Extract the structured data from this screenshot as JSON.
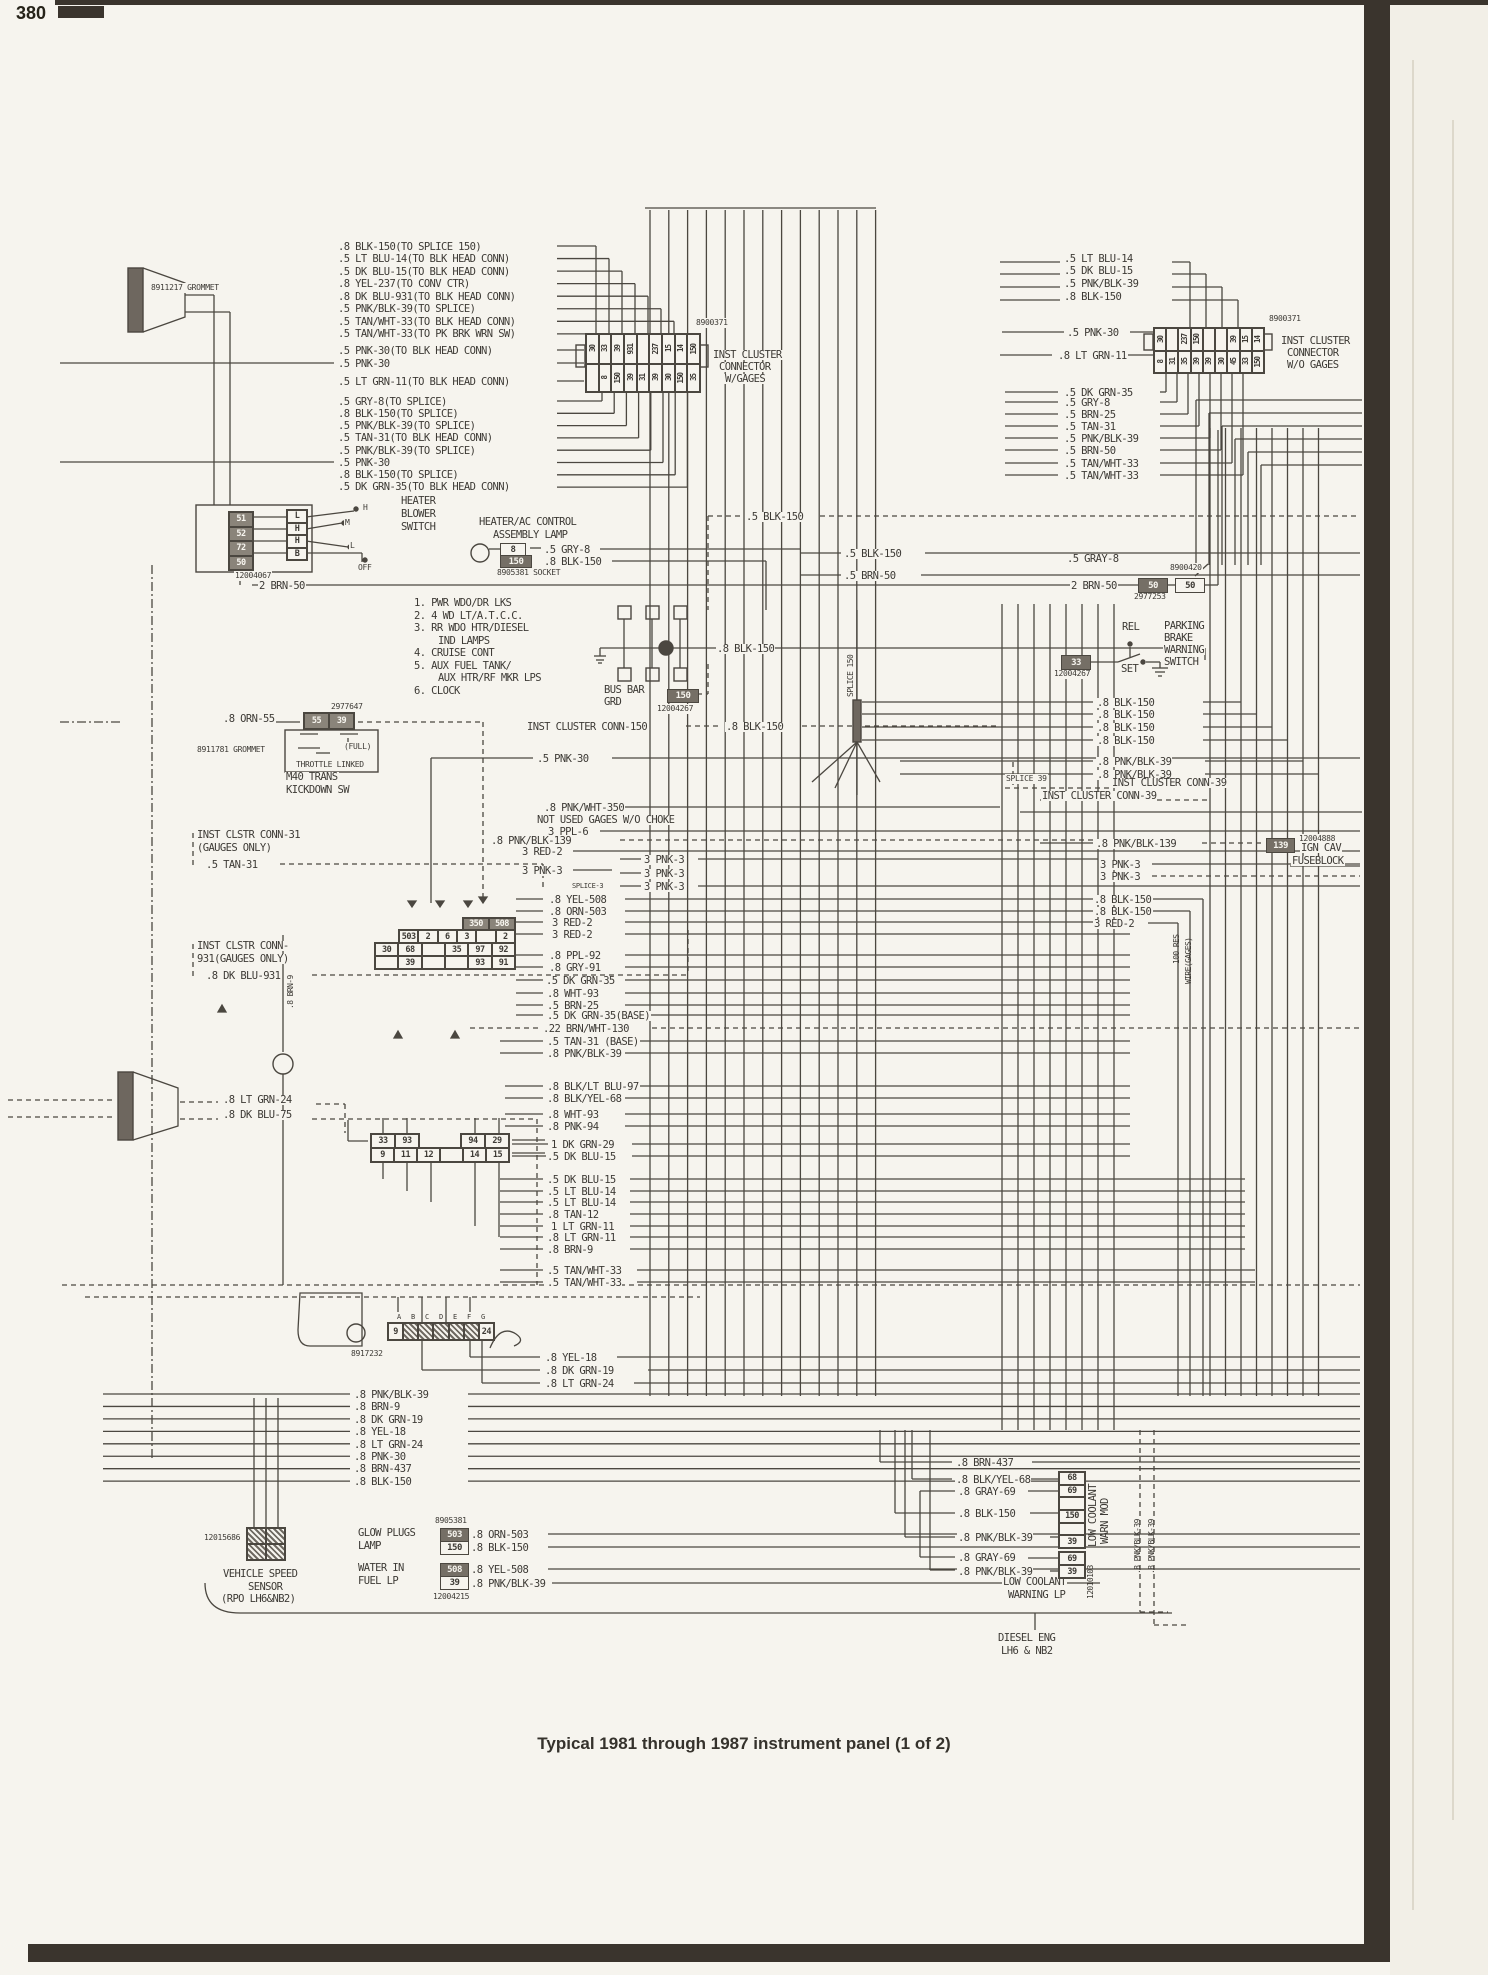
{
  "page": {
    "number": "380",
    "caption": "Typical 1981 through 1987 instrument panel (1 of 2)"
  },
  "colors": {
    "paper": "#f6f4ee",
    "ink": "#3d3a35",
    "line": "#4b4740",
    "shade": "#756f66",
    "edge": "#3a342d"
  },
  "labels": [
    [
      ".8 BLK-150(TO SPLICE 150)",
      337,
      242
    ],
    [
      ".5 LT BLU-14(TO BLK HEAD CONN)",
      337,
      254
    ],
    [
      ".5 DK BLU-15(TO BLK HEAD CONN)",
      337,
      267
    ],
    [
      ".8 YEL-237(TO CONV CTR)",
      337,
      279
    ],
    [
      ".8 DK BLU-931(TO BLK HEAD CONN)",
      337,
      292
    ],
    [
      ".5 PNK/BLK-39(TO SPLICE)",
      337,
      304
    ],
    [
      ".5 TAN/WHT-33(TO BLK HEAD CONN)",
      337,
      317
    ],
    [
      ".5 TAN/WHT-33(TO PK BRK WRN SW)",
      337,
      329
    ],
    [
      ".5 PNK-30(TO BLK HEAD CONN)",
      337,
      346
    ],
    [
      ".5 PNK-30",
      337,
      359
    ],
    [
      ".5 LT GRN-11(TO BLK HEAD CONN)",
      337,
      377
    ],
    [
      ".5 GRY-8(TO SPLICE)",
      337,
      397
    ],
    [
      ".8 BLK-150(TO SPLICE)",
      337,
      409
    ],
    [
      ".5 PNK/BLK-39(TO SPLICE)",
      337,
      421
    ],
    [
      ".5 TAN-31(TO BLK HEAD CONN)",
      337,
      433
    ],
    [
      ".5 PNK/BLK-39(TO SPLICE)",
      337,
      446
    ],
    [
      ".5 PNK-30",
      337,
      458
    ],
    [
      ".8 BLK-150(TO SPLICE)",
      337,
      470
    ],
    [
      ".5 DK GRN-35(TO BLK HEAD CONN)",
      337,
      482
    ],
    [
      "8900371",
      695,
      318,
      "s"
    ],
    [
      "INST CLUSTER",
      712,
      350
    ],
    [
      "CONNECTOR",
      718,
      362
    ],
    [
      "W/GAGES",
      724,
      374
    ],
    [
      "8911217 GROMMET",
      150,
      283,
      "s"
    ],
    [
      ".5 LT BLU-14",
      1063,
      254
    ],
    [
      ".5 DK BLU-15",
      1063,
      266
    ],
    [
      ".5 PNK/BLK-39",
      1063,
      279
    ],
    [
      ".8 BLK-150",
      1063,
      292
    ],
    [
      ".5 PNK-30",
      1066,
      328
    ],
    [
      ".8 LT GRN-11",
      1057,
      351
    ],
    [
      ".5 DK GRN-35",
      1063,
      388
    ],
    [
      ".5 GRY-8",
      1063,
      398
    ],
    [
      ".5 BRN-25",
      1063,
      410
    ],
    [
      ".5 TAN-31",
      1063,
      422
    ],
    [
      ".5 PNK/BLK-39",
      1063,
      434
    ],
    [
      ".5 BRN-50",
      1063,
      446
    ],
    [
      ".5 TAN/WHT-33",
      1063,
      459
    ],
    [
      ".5 TAN/WHT-33",
      1063,
      471
    ],
    [
      "8900371",
      1268,
      314,
      "s"
    ],
    [
      "INST CLUSTER",
      1280,
      336
    ],
    [
      "CONNECTOR",
      1286,
      348
    ],
    [
      "W/O GAGES",
      1286,
      360
    ],
    [
      "HEATER",
      400,
      496
    ],
    [
      "BLOWER",
      400,
      509
    ],
    [
      "SWITCH",
      400,
      522
    ],
    [
      "12004067",
      234,
      571,
      "s"
    ],
    [
      "2 BRN-50",
      258,
      581
    ],
    [
      "H",
      362,
      503,
      "s"
    ],
    [
      "M",
      344,
      518,
      "s"
    ],
    [
      "L",
      349,
      541,
      "s"
    ],
    [
      "OFF",
      357,
      563,
      "s"
    ],
    [
      "HEATER/AC CONTROL",
      478,
      517
    ],
    [
      "ASSEMBLY LAMP",
      492,
      530
    ],
    [
      ".5 GRY-8",
      543,
      545
    ],
    [
      ".8 BLK-150",
      543,
      557
    ],
    [
      "8905381 SOCKET",
      496,
      568,
      "s"
    ],
    [
      "1. PWR WDO/DR LKS",
      413,
      598
    ],
    [
      "2. 4 WD LT/A.T.C.C.",
      413,
      611
    ],
    [
      "3. RR WDO HTR/DIESEL",
      413,
      623
    ],
    [
      "IND LAMPS",
      437,
      636
    ],
    [
      "4. CRUISE CONT",
      413,
      648
    ],
    [
      "5. AUX FUEL TANK/",
      413,
      661
    ],
    [
      "AUX HTR/RF MKR LPS",
      437,
      673
    ],
    [
      "6. CLOCK",
      413,
      686
    ],
    [
      ".8 BLK-150",
      716,
      644
    ],
    [
      "BUS BAR",
      603,
      685
    ],
    [
      "GRD",
      603,
      697
    ],
    [
      "12004267",
      656,
      704,
      "s"
    ],
    [
      "INST CLUSTER CONN-150",
      526,
      722
    ],
    [
      ".8 BLK-150",
      725,
      722
    ],
    [
      ".5 PNK-30",
      536,
      754
    ],
    [
      ".5 BLK-150",
      745,
      512
    ],
    [
      ".5 BLK-150",
      843,
      549
    ],
    [
      ".5 BRN-50",
      843,
      571
    ],
    [
      ".5 GRAY-8",
      1066,
      554
    ],
    [
      "8900420",
      1169,
      563,
      "s"
    ],
    [
      "2 BRN-50",
      1070,
      581
    ],
    [
      "2977253",
      1133,
      592,
      "s"
    ],
    [
      "REL",
      1121,
      622
    ],
    [
      "SET",
      1120,
      664
    ],
    [
      "PARKING",
      1163,
      621
    ],
    [
      "BRAKE",
      1163,
      633
    ],
    [
      "WARNING",
      1163,
      645
    ],
    [
      "SWITCH",
      1163,
      657
    ],
    [
      "12004267",
      1053,
      669,
      "s"
    ],
    [
      ".8 BLK-150",
      1096,
      698
    ],
    [
      ".8 BLK-150",
      1096,
      710
    ],
    [
      ".8 BLK-150",
      1096,
      723
    ],
    [
      ".8 BLK-150",
      1096,
      736
    ],
    [
      ".8 PNK/BLK-39",
      1096,
      757
    ],
    [
      ".8 PNK/BLK-39",
      1096,
      770
    ],
    [
      "SPLICE 39",
      1005,
      774,
      "s"
    ],
    [
      "INST CLUSTER CONN-39",
      1111,
      778
    ],
    [
      "INST CLUSTER CONN-39",
      1041,
      791
    ],
    [
      "SPLICE 150",
      846,
      698,
      "vs"
    ],
    [
      ".8 ORN-55",
      222,
      714
    ],
    [
      "2977647",
      330,
      702,
      "s"
    ],
    [
      "8911781 GROMMET",
      196,
      745,
      "s"
    ],
    [
      "(FULL)",
      343,
      742,
      "s"
    ],
    [
      "THROTTLE LINKED",
      295,
      760,
      "s"
    ],
    [
      "M40 TRANS",
      285,
      772
    ],
    [
      "KICKDOWN SW",
      285,
      785
    ],
    [
      "INST CLSTR CONN-31",
      196,
      830
    ],
    [
      "(GAUGES ONLY)",
      196,
      843
    ],
    [
      ".5 TAN-31",
      205,
      860
    ],
    [
      "INST CLSTR CONN-",
      196,
      941
    ],
    [
      "931(GAUGES ONLY)",
      196,
      954
    ],
    [
      ".8 DK BLU-931",
      205,
      971
    ],
    [
      ".8 PNK/WHT-350",
      543,
      803
    ],
    [
      "NOT USED GAGES W/O CHOKE",
      536,
      815
    ],
    [
      "3 PPL-6",
      547,
      827
    ],
    [
      ".8 PNK/BLK-139",
      490,
      836
    ],
    [
      "3 RED-2",
      521,
      847
    ],
    [
      "3 PNK-3",
      521,
      866
    ],
    [
      "SPLICE-3",
      571,
      881,
      "t"
    ],
    [
      "3 PNK-3",
      643,
      855
    ],
    [
      "3 PNK-3",
      643,
      869
    ],
    [
      "3 PNK-3",
      643,
      882
    ],
    [
      ".8 YEL-508",
      548,
      895
    ],
    [
      ".8 ORN-503",
      548,
      907
    ],
    [
      "3 RED-2",
      551,
      918
    ],
    [
      "3 RED-2",
      551,
      930
    ],
    [
      ".8 PPL-92",
      548,
      951
    ],
    [
      ".8 GRY-91",
      548,
      963
    ],
    [
      ".5 DK GRN-35",
      545,
      976
    ],
    [
      ".8 WHT-93",
      546,
      989
    ],
    [
      ".5 BRN-25",
      546,
      1001
    ],
    [
      ".5 DK GRN-35(BASE)",
      546,
      1011
    ],
    [
      ".22 BRN/WHT-130",
      542,
      1024
    ],
    [
      ".5 TAN-31 (BASE)",
      546,
      1037
    ],
    [
      ".8 PNK/BLK-39",
      546,
      1049
    ],
    [
      ".8 PNK/BLK-139",
      1095,
      839
    ],
    [
      "12004888",
      1298,
      834,
      "s"
    ],
    [
      "IGN CAV",
      1300,
      843
    ],
    [
      "FUSEBLOCK",
      1291,
      856
    ],
    [
      "3 PNK-3",
      1099,
      860
    ],
    [
      "3 PNK-3",
      1099,
      872
    ],
    [
      ".8 BLK-150",
      1093,
      895
    ],
    [
      ".8 BLK-150",
      1093,
      907
    ],
    [
      "3 RED-2",
      1093,
      919
    ],
    [
      "100 RES",
      1172,
      965,
      "vs"
    ],
    [
      "WIRE(GAGES)",
      1184,
      985,
      "vs"
    ],
    [
      ".8 BRN-9",
      286,
      1010,
      "vs"
    ],
    [
      ".8 BLK/LT BLU-97",
      546,
      1082
    ],
    [
      ".8 BLK/YEL-68",
      546,
      1094
    ],
    [
      ".8 WHT-93",
      546,
      1110
    ],
    [
      ".8 PNK-94",
      546,
      1122
    ],
    [
      "1 DK GRN-29",
      550,
      1140
    ],
    [
      ".5 DK BLU-15",
      546,
      1152
    ],
    [
      ".5 DK BLU-15",
      546,
      1175
    ],
    [
      ".5 LT BLU-14",
      546,
      1187
    ],
    [
      ".5 LT BLU-14",
      546,
      1198
    ],
    [
      ".8 TAN-12",
      546,
      1210
    ],
    [
      "1 LT GRN-11",
      550,
      1222
    ],
    [
      ".8 LT GRN-11",
      546,
      1233
    ],
    [
      ".8 BRN-9",
      546,
      1245
    ],
    [
      ".5 TAN/WHT-33",
      546,
      1266
    ],
    [
      ".5 TAN/WHT-33",
      546,
      1278
    ],
    [
      ".8 LT GRN-24",
      222,
      1095
    ],
    [
      ".8 DK BLU-75",
      222,
      1110
    ],
    [
      "A",
      396,
      1312,
      "t"
    ],
    [
      "B",
      410,
      1312,
      "t"
    ],
    [
      "C",
      424,
      1312,
      "t"
    ],
    [
      "D",
      438,
      1312,
      "t"
    ],
    [
      "E",
      452,
      1312,
      "t"
    ],
    [
      "F",
      466,
      1312,
      "t"
    ],
    [
      "G",
      480,
      1312,
      "t"
    ],
    [
      "8917232",
      350,
      1349,
      "s"
    ],
    [
      ".8 YEL-18",
      544,
      1353
    ],
    [
      ".8 DK GRN-19",
      544,
      1366
    ],
    [
      ".8 LT GRN-24",
      544,
      1379
    ],
    [
      ".8 PNK/BLK-39",
      353,
      1390
    ],
    [
      ".8 BRN-9",
      353,
      1402
    ],
    [
      ".8 DK GRN-19",
      353,
      1415
    ],
    [
      ".8 YEL-18",
      353,
      1427
    ],
    [
      ".8 LT GRN-24",
      353,
      1440
    ],
    [
      ".8 PNK-30",
      353,
      1452
    ],
    [
      ".8 BRN-437",
      353,
      1464
    ],
    [
      ".8 BLK-150",
      353,
      1477
    ],
    [
      "12015686",
      203,
      1533,
      "s"
    ],
    [
      "VEHICLE SPEED",
      222,
      1569
    ],
    [
      "SENSOR",
      247,
      1582
    ],
    [
      "(RPO LH6&NB2)",
      220,
      1594
    ],
    [
      "GLOW PLUGS",
      357,
      1528
    ],
    [
      "LAMP",
      357,
      1541
    ],
    [
      "8905381",
      434,
      1516,
      "s"
    ],
    [
      ".8 ORN-503",
      470,
      1530
    ],
    [
      ".8 BLK-150",
      470,
      1543
    ],
    [
      "WATER IN",
      357,
      1563
    ],
    [
      "FUEL LP",
      357,
      1576
    ],
    [
      ".8 YEL-508",
      470,
      1565
    ],
    [
      ".8 PNK/BLK-39",
      470,
      1579
    ],
    [
      "12004215",
      432,
      1592,
      "s"
    ],
    [
      ".8 BRN-437",
      955,
      1458
    ],
    [
      ".8 BLK/YEL-68",
      955,
      1475
    ],
    [
      ".8 GRAY-69",
      957,
      1487
    ],
    [
      ".8 BLK-150",
      957,
      1509
    ],
    [
      ".8 PNK/BLK-39",
      957,
      1533
    ],
    [
      ".8 GRAY-69",
      957,
      1553
    ],
    [
      ".8 PNK/BLK-39",
      957,
      1567
    ],
    [
      "LOW COOLANT",
      1088,
      1548,
      "v"
    ],
    [
      "WARN MOD",
      1100,
      1545,
      "v"
    ],
    [
      "LOW COOLANT",
      1002,
      1577
    ],
    [
      "WARNING LP",
      1007,
      1590
    ],
    [
      "12010103",
      1086,
      1600,
      "vs"
    ],
    [
      ".8 PNK/BLK-39",
      1133,
      1575,
      "vs"
    ],
    [
      ".8 PNK/BLK-39",
      1147,
      1575,
      "vs"
    ],
    [
      "DIESEL ENG",
      997,
      1633
    ],
    [
      "LH6 & NB2",
      1000,
      1646
    ]
  ],
  "boxes": [
    [
      "8",
      500,
      543,
      24,
      11,
      0
    ],
    [
      "150",
      500,
      555,
      30,
      11,
      1
    ],
    [
      "150",
      667,
      689,
      30,
      12,
      1
    ],
    [
      "50",
      1138,
      578,
      28,
      13,
      1
    ],
    [
      "50",
      1175,
      578,
      28,
      13,
      0
    ],
    [
      "33",
      1061,
      655,
      28,
      13,
      1
    ],
    [
      "139",
      1266,
      838,
      27,
      13,
      1
    ],
    [
      "503",
      440,
      1528,
      27,
      12,
      1
    ],
    [
      "150",
      440,
      1541,
      27,
      12,
      0
    ],
    [
      "508",
      440,
      1563,
      27,
      12,
      1
    ],
    [
      "39",
      440,
      1576,
      27,
      12,
      0
    ]
  ],
  "connectors": [
    {
      "n": "inst-cluster-conn-w-gages-top",
      "x": 585,
      "y": 333,
      "w": 114,
      "h": 30,
      "cells": [
        "30",
        "33",
        "39",
        "931",
        "",
        "237",
        "15",
        "14",
        "150"
      ],
      "rot": 1
    },
    {
      "n": "inst-cluster-conn-w-gages-bottom",
      "x": 585,
      "y": 363,
      "w": 114,
      "h": 28,
      "cells": [
        "",
        "8",
        "150",
        "39",
        "31",
        "39",
        "30",
        "150",
        "35"
      ],
      "rot": 1
    },
    {
      "n": "inst-cluster-conn-wo-gages-top",
      "x": 1153,
      "y": 327,
      "w": 110,
      "h": 23,
      "cells": [
        "30",
        "",
        "237",
        "150",
        "",
        "",
        "39",
        "15",
        "14"
      ],
      "rot": 1
    },
    {
      "n": "inst-cluster-conn-wo-gages-bottom",
      "x": 1153,
      "y": 350,
      "w": 110,
      "h": 22,
      "cells": [
        "8",
        "31",
        "35",
        "39",
        "39",
        "30",
        "45",
        "33",
        "150"
      ],
      "rot": 1
    },
    {
      "n": "heater-blower-connector",
      "x": 228,
      "y": 511,
      "w": 24,
      "h": 58,
      "col": 1,
      "cells": [
        "51",
        "52",
        "72",
        "50"
      ],
      "sh": 1
    },
    {
      "n": "blower-switch-terminals",
      "x": 286,
      "y": 509,
      "w": 20,
      "h": 50,
      "col": 1,
      "cells": [
        "L",
        "H",
        "H",
        "B"
      ]
    },
    {
      "n": "kickdown-connector",
      "x": 303,
      "y": 712,
      "w": 50,
      "h": 16,
      "cells": [
        "55",
        "39"
      ],
      "sh": 1
    },
    {
      "n": "mid-connector-row-a",
      "x": 462,
      "y": 917,
      "w": 52,
      "h": 12,
      "cells": [
        "350",
        "508"
      ],
      "sh": 1
    },
    {
      "n": "mid-connector-row-b",
      "x": 398,
      "y": 929,
      "w": 116,
      "h": 13,
      "cells": [
        "503",
        "2",
        "6",
        "3",
        "",
        "2"
      ]
    },
    {
      "n": "mid-connector-row-c",
      "x": 374,
      "y": 942,
      "w": 140,
      "h": 13,
      "cells": [
        "30",
        "68",
        "",
        "35",
        "97",
        "92"
      ]
    },
    {
      "n": "mid-connector-row-d",
      "x": 374,
      "y": 955,
      "w": 140,
      "h": 13,
      "cells": [
        "",
        "39",
        "",
        "",
        "93",
        "91"
      ]
    },
    {
      "n": "conn-33-93",
      "x": 370,
      "y": 1133,
      "w": 48,
      "h": 14,
      "cells": [
        "33",
        "93"
      ]
    },
    {
      "n": "conn-94-29",
      "x": 460,
      "y": 1133,
      "w": 48,
      "h": 14,
      "cells": [
        "94",
        "29"
      ]
    },
    {
      "n": "conn-9-15",
      "x": 370,
      "y": 1147,
      "w": 138,
      "h": 14,
      "cells": [
        "9",
        "11",
        "12",
        "",
        "14",
        "15"
      ]
    },
    {
      "n": "bottom-connector",
      "x": 387,
      "y": 1322,
      "w": 106,
      "h": 17,
      "cells": [
        "9",
        "",
        "",
        "",
        "",
        "",
        "24"
      ],
      "he": 1
    },
    {
      "n": "vss-connector-top",
      "x": 246,
      "y": 1527,
      "w": 38,
      "h": 16,
      "cells": [
        "",
        ""
      ],
      "he": 1
    },
    {
      "n": "vss-connector-bottom",
      "x": 246,
      "y": 1543,
      "w": 38,
      "h": 16,
      "cells": [
        "",
        ""
      ],
      "he": 1
    },
    {
      "n": "low-coolant-warn-mod",
      "x": 1058,
      "y": 1471,
      "w": 26,
      "h": 76,
      "col": 1,
      "cells": [
        "68",
        "69",
        "",
        "150",
        "",
        "39"
      ]
    },
    {
      "n": "low-coolant-lamp-69",
      "x": 1058,
      "y": 1551,
      "w": 26,
      "h": 13,
      "cells": [
        "69"
      ]
    },
    {
      "n": "low-coolant-lamp-39",
      "x": 1058,
      "y": 1564,
      "w": 26,
      "h": 13,
      "cells": [
        "39"
      ]
    }
  ]
}
